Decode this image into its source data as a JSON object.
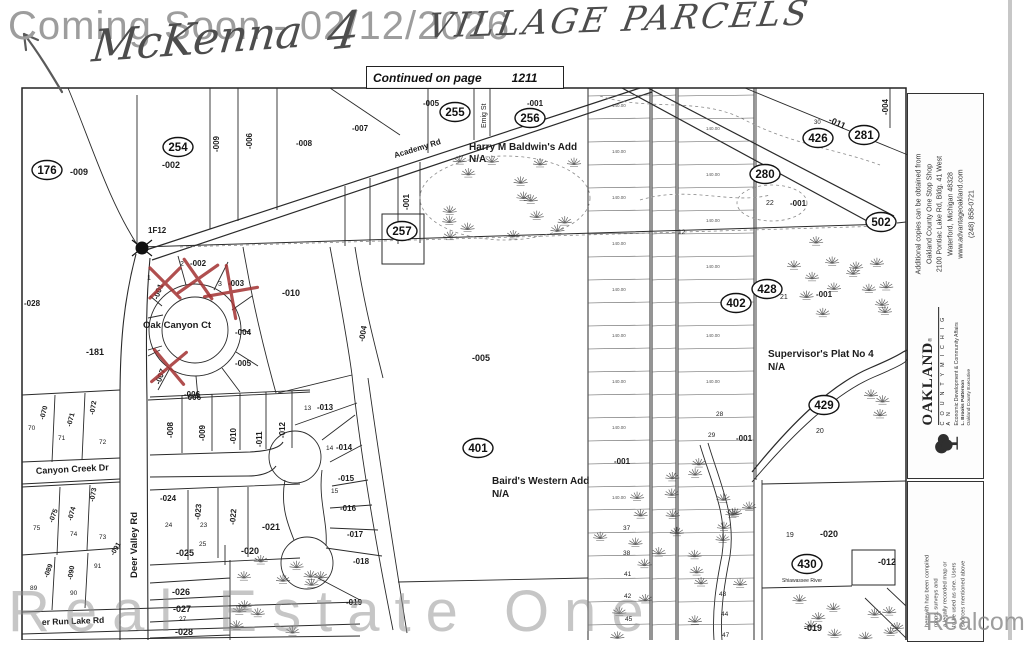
{
  "header": {
    "coming_soon": "Coming Soon - 02/12/2026",
    "handwritten_name": "McKenna",
    "handwritten_number": "4",
    "handwritten_rest": "VILLAGE PARCELS",
    "continued_label": "Continued on page",
    "continued_page": "1211"
  },
  "watermarks": {
    "bottom_left": "Real Estate One",
    "bottom_right": "Realcomp"
  },
  "sidebar": {
    "info_lines": [
      "Additional copies can be obtained from",
      "Oakland County One Stop Shop",
      "2100 Pontiac Lake Rd, Bldg. 41 West",
      "Waterford, Michigan 48328",
      "www.advantageoakland.com",
      "(248) 858-0721"
    ],
    "logo": {
      "name": "OAKLAND",
      "reg": "®",
      "subtitle": "C O U N T Y   M I C H I G A N",
      "dept": "Economic Development & Community Affairs",
      "exec_name": "L. Brooks Patterson",
      "exec_title": "Oakland County Executive"
    },
    "disclaimer_lines": [
      "herewith has been compiled",
      "maps, surveys and",
      "a legally recorded map or",
      "to be used as one.  Users",
      "sources mentioned above"
    ]
  },
  "map": {
    "parcel_circles": [
      {
        "id": "176",
        "x": 47,
        "y": 170
      },
      {
        "id": "254",
        "x": 178,
        "y": 147
      },
      {
        "id": "255",
        "x": 455,
        "y": 112
      },
      {
        "id": "256",
        "x": 530,
        "y": 118
      },
      {
        "id": "257",
        "x": 402,
        "y": 231
      },
      {
        "id": "280",
        "x": 765,
        "y": 174
      },
      {
        "id": "281",
        "x": 864,
        "y": 135
      },
      {
        "id": "426",
        "x": 818,
        "y": 138
      },
      {
        "id": "402",
        "x": 736,
        "y": 303
      },
      {
        "id": "428",
        "x": 767,
        "y": 289
      },
      {
        "id": "429",
        "x": 824,
        "y": 405
      },
      {
        "id": "430",
        "x": 807,
        "y": 564
      },
      {
        "id": "401",
        "x": 478,
        "y": 448
      },
      {
        "id": "502",
        "x": 881,
        "y": 222
      }
    ],
    "labels": [
      {
        "t": "-009",
        "x": 70,
        "y": 175
      },
      {
        "t": "-002",
        "x": 162,
        "y": 168
      },
      {
        "t": "-009",
        "x": 219,
        "y": 152,
        "r": -90,
        "s": 8
      },
      {
        "t": "-006",
        "x": 252,
        "y": 149,
        "r": -90,
        "s": 8
      },
      {
        "t": "-008",
        "x": 296,
        "y": 146,
        "s": 8
      },
      {
        "t": "-007",
        "x": 352,
        "y": 131,
        "s": 8
      },
      {
        "t": "-005",
        "x": 423,
        "y": 106,
        "s": 8
      },
      {
        "t": "Emig St",
        "x": 486,
        "y": 128,
        "r": -90,
        "s": 7,
        "w": 400
      },
      {
        "t": "-001",
        "x": 527,
        "y": 106,
        "s": 8
      },
      {
        "t": "Academy Rd",
        "x": 395,
        "y": 158,
        "r": -17,
        "s": 8
      },
      {
        "t": "Harry M Baldwin's Add",
        "x": 469,
        "y": 150,
        "s": 10
      },
      {
        "t": "N/A",
        "x": 469,
        "y": 162,
        "s": 10
      },
      {
        "t": "30",
        "x": 814,
        "y": 124,
        "s": 6,
        "w": 400
      },
      {
        "t": "-011",
        "x": 828,
        "y": 122,
        "r": 24,
        "s": 9
      },
      {
        "t": "-004",
        "x": 888,
        "y": 115,
        "r": -90,
        "s": 8
      },
      {
        "t": "22",
        "x": 766,
        "y": 205,
        "s": 7,
        "w": 400
      },
      {
        "t": "-001",
        "x": 790,
        "y": 206,
        "s": 8
      },
      {
        "t": "-001",
        "x": 409,
        "y": 210,
        "r": -90,
        "s": 8
      },
      {
        "t": "1F12",
        "x": 148,
        "y": 233,
        "s": 8
      },
      {
        "t": "1",
        "x": 147,
        "y": 280,
        "s": 7,
        "w": 400
      },
      {
        "t": "-001",
        "x": 158,
        "y": 300,
        "r": -70,
        "s": 8
      },
      {
        "t": "2",
        "x": 180,
        "y": 266,
        "s": 7,
        "w": 400
      },
      {
        "t": "-002",
        "x": 190,
        "y": 266,
        "s": 8
      },
      {
        "t": "3",
        "x": 218,
        "y": 286,
        "s": 7,
        "w": 400
      },
      {
        "t": "-003",
        "x": 228,
        "y": 286,
        "s": 8
      },
      {
        "t": "-004",
        "x": 235,
        "y": 335,
        "s": 8
      },
      {
        "t": "-005",
        "x": 235,
        "y": 366,
        "s": 8
      },
      {
        "t": "-006",
        "x": 185,
        "y": 400,
        "s": 8
      },
      {
        "t": "-007",
        "x": 160,
        "y": 385,
        "r": -70,
        "s": 8
      },
      {
        "t": "-010",
        "x": 282,
        "y": 296,
        "s": 9
      },
      {
        "t": "Oak Canyon Ct",
        "x": 143,
        "y": 328,
        "s": 9.5
      },
      {
        "t": "-181",
        "x": 86,
        "y": 355,
        "s": 9
      },
      {
        "t": "-028",
        "x": 24,
        "y": 306,
        "s": 8
      },
      {
        "t": "-004",
        "x": 364,
        "y": 342,
        "r": -80,
        "s": 8
      },
      {
        "t": "-005",
        "x": 472,
        "y": 361,
        "s": 9
      },
      {
        "t": "Baird's Western Add",
        "x": 492,
        "y": 484,
        "s": 10
      },
      {
        "t": "N/A",
        "x": 492,
        "y": 497,
        "s": 10
      },
      {
        "t": "Supervisor's Plat No 4",
        "x": 768,
        "y": 357,
        "s": 10
      },
      {
        "t": "N/A",
        "x": 768,
        "y": 370,
        "s": 10
      },
      {
        "t": "21",
        "x": 780,
        "y": 299,
        "s": 7,
        "w": 400
      },
      {
        "t": "-001",
        "x": 816,
        "y": 297,
        "s": 8
      },
      {
        "t": "20",
        "x": 816,
        "y": 433,
        "s": 7,
        "w": 400
      },
      {
        "t": "28",
        "x": 716,
        "y": 416,
        "s": 6.5,
        "w": 400
      },
      {
        "t": "29",
        "x": 708,
        "y": 437,
        "s": 6.5,
        "w": 400
      },
      {
        "t": "-001",
        "x": 736,
        "y": 441,
        "s": 8
      },
      {
        "t": "12",
        "x": 678,
        "y": 234,
        "s": 6.5,
        "w": 400
      },
      {
        "t": "-001",
        "x": 614,
        "y": 464,
        "s": 8
      },
      {
        "t": "37",
        "x": 623,
        "y": 530,
        "s": 6.5,
        "w": 400
      },
      {
        "t": "38",
        "x": 623,
        "y": 555,
        "s": 6.5,
        "w": 400
      },
      {
        "t": "41",
        "x": 624,
        "y": 576,
        "s": 6.5,
        "w": 400
      },
      {
        "t": "42",
        "x": 624,
        "y": 598,
        "s": 6.5,
        "w": 400
      },
      {
        "t": "45",
        "x": 625,
        "y": 621,
        "s": 6.5,
        "w": 400
      },
      {
        "t": "43",
        "x": 719,
        "y": 596,
        "s": 6.5,
        "w": 400
      },
      {
        "t": "44",
        "x": 721,
        "y": 616,
        "s": 6.5,
        "w": 400
      },
      {
        "t": "47",
        "x": 722,
        "y": 637,
        "s": 6.5,
        "w": 400
      },
      {
        "t": "19",
        "x": 786,
        "y": 537,
        "s": 7,
        "w": 400
      },
      {
        "t": "-020",
        "x": 820,
        "y": 537,
        "s": 9
      },
      {
        "t": "-012",
        "x": 878,
        "y": 565,
        "s": 9
      },
      {
        "t": "-019",
        "x": 804,
        "y": 631,
        "s": 9
      },
      {
        "t": "Shiawassee River",
        "x": 782,
        "y": 582,
        "s": 5,
        "w": 400
      },
      {
        "t": "-070",
        "x": 44,
        "y": 420,
        "r": -75,
        "s": 7
      },
      {
        "t": "70",
        "x": 28,
        "y": 430,
        "s": 6.5,
        "w": 400
      },
      {
        "t": "-071",
        "x": 71,
        "y": 427,
        "r": -75,
        "s": 7
      },
      {
        "t": "71",
        "x": 58,
        "y": 440,
        "s": 6.5,
        "w": 400
      },
      {
        "t": "-072",
        "x": 94,
        "y": 415,
        "r": -80,
        "s": 7
      },
      {
        "t": "72",
        "x": 99,
        "y": 444,
        "s": 6.5,
        "w": 400
      },
      {
        "t": "Canyon Creek Dr",
        "x": 36,
        "y": 474,
        "r": -3,
        "s": 9
      },
      {
        "t": "-073",
        "x": 94,
        "y": 502,
        "r": -80,
        "s": 7
      },
      {
        "t": "73",
        "x": 99,
        "y": 539,
        "s": 6.5,
        "w": 400
      },
      {
        "t": "-074",
        "x": 72,
        "y": 521,
        "r": -75,
        "s": 7
      },
      {
        "t": "74",
        "x": 70,
        "y": 536,
        "s": 6.5,
        "w": 400
      },
      {
        "t": "-075",
        "x": 53,
        "y": 523,
        "r": -70,
        "s": 7
      },
      {
        "t": "75",
        "x": 33,
        "y": 530,
        "s": 6.5,
        "w": 400
      },
      {
        "t": "-089",
        "x": 48,
        "y": 578,
        "r": -70,
        "s": 7
      },
      {
        "t": "89",
        "x": 30,
        "y": 590,
        "s": 6.5,
        "w": 400
      },
      {
        "t": "-090",
        "x": 72,
        "y": 580,
        "r": -80,
        "s": 7
      },
      {
        "t": "90",
        "x": 70,
        "y": 595,
        "s": 6.5,
        "w": 400
      },
      {
        "t": "-091",
        "x": 114,
        "y": 556,
        "r": -60,
        "s": 7
      },
      {
        "t": "91",
        "x": 94,
        "y": 568,
        "s": 6.5,
        "w": 400
      },
      {
        "t": "Deer Valley Rd",
        "x": 137,
        "y": 578,
        "r": -90,
        "s": 9.5
      },
      {
        "t": "er Run Lake Rd",
        "x": 42,
        "y": 625,
        "r": -2,
        "s": 8.5
      },
      {
        "t": "-006",
        "x": 184,
        "y": 397,
        "s": 8
      },
      {
        "t": "-008",
        "x": 173,
        "y": 438,
        "r": -90,
        "s": 8
      },
      {
        "t": "-009",
        "x": 205,
        "y": 441,
        "r": -90,
        "s": 8
      },
      {
        "t": "-010",
        "x": 236,
        "y": 444,
        "r": -90,
        "s": 8
      },
      {
        "t": "-011",
        "x": 262,
        "y": 447,
        "r": -90,
        "s": 8
      },
      {
        "t": "-012",
        "x": 285,
        "y": 438,
        "r": -90,
        "s": 8
      },
      {
        "t": "-024",
        "x": 160,
        "y": 501,
        "s": 8
      },
      {
        "t": "24",
        "x": 165,
        "y": 527,
        "s": 6.5,
        "w": 400
      },
      {
        "t": "-023",
        "x": 200,
        "y": 520,
        "r": -85,
        "s": 8
      },
      {
        "t": "23",
        "x": 200,
        "y": 527,
        "s": 6.5,
        "w": 400
      },
      {
        "t": "25",
        "x": 199,
        "y": 546,
        "s": 6.5,
        "w": 400
      },
      {
        "t": "-022",
        "x": 235,
        "y": 525,
        "r": -85,
        "s": 8
      },
      {
        "t": "-021",
        "x": 262,
        "y": 530,
        "s": 9
      },
      {
        "t": "-025",
        "x": 176,
        "y": 556,
        "s": 9
      },
      {
        "t": "-020",
        "x": 241,
        "y": 554,
        "s": 9
      },
      {
        "t": "-026",
        "x": 172,
        "y": 595,
        "s": 9
      },
      {
        "t": "-027",
        "x": 173,
        "y": 612,
        "s": 9
      },
      {
        "t": "27",
        "x": 179,
        "y": 621,
        "s": 6.5,
        "w": 400
      },
      {
        "t": "-028",
        "x": 175,
        "y": 635,
        "s": 9
      },
      {
        "t": "13",
        "x": 304,
        "y": 410,
        "s": 6.5,
        "w": 400
      },
      {
        "t": "-013",
        "x": 317,
        "y": 410,
        "s": 8
      },
      {
        "t": "14",
        "x": 326,
        "y": 450,
        "s": 6.5,
        "w": 400
      },
      {
        "t": "-014",
        "x": 336,
        "y": 450,
        "s": 8
      },
      {
        "t": "-015",
        "x": 338,
        "y": 481,
        "s": 8
      },
      {
        "t": "15",
        "x": 331,
        "y": 493,
        "s": 6.5,
        "w": 400
      },
      {
        "t": "-016",
        "x": 340,
        "y": 511,
        "s": 8
      },
      {
        "t": "-017",
        "x": 347,
        "y": 537,
        "s": 8
      },
      {
        "t": "-018",
        "x": 353,
        "y": 564,
        "s": 8
      },
      {
        "t": "-019",
        "x": 346,
        "y": 605,
        "s": 8
      },
      {
        "t": "140.00",
        "x": 612,
        "y": 107,
        "s": 4.5,
        "w": 400,
        "c": "#555"
      },
      {
        "t": "140.00",
        "x": 612,
        "y": 153,
        "s": 4.5,
        "w": 400,
        "c": "#555"
      },
      {
        "t": "140.00",
        "x": 612,
        "y": 199,
        "s": 4.5,
        "w": 400,
        "c": "#555"
      },
      {
        "t": "140.00",
        "x": 612,
        "y": 245,
        "s": 4.5,
        "w": 400,
        "c": "#555"
      },
      {
        "t": "140.00",
        "x": 612,
        "y": 291,
        "s": 4.5,
        "w": 400,
        "c": "#555"
      },
      {
        "t": "140.00",
        "x": 612,
        "y": 337,
        "s": 4.5,
        "w": 400,
        "c": "#555"
      },
      {
        "t": "140.00",
        "x": 612,
        "y": 383,
        "s": 4.5,
        "w": 400,
        "c": "#555"
      },
      {
        "t": "140.00",
        "x": 612,
        "y": 429,
        "s": 4.5,
        "w": 400,
        "c": "#555"
      },
      {
        "t": "140.00",
        "x": 612,
        "y": 499,
        "s": 4.5,
        "w": 400,
        "c": "#555"
      },
      {
        "t": "140.00",
        "x": 706,
        "y": 130,
        "s": 4.5,
        "w": 400,
        "c": "#555"
      },
      {
        "t": "140.00",
        "x": 706,
        "y": 176,
        "s": 4.5,
        "w": 400,
        "c": "#555"
      },
      {
        "t": "140.00",
        "x": 706,
        "y": 222,
        "s": 4.5,
        "w": 400,
        "c": "#555"
      },
      {
        "t": "140.00",
        "x": 706,
        "y": 268,
        "s": 4.5,
        "w": 400,
        "c": "#555"
      },
      {
        "t": "140.00",
        "x": 706,
        "y": 337,
        "s": 4.5,
        "w": 400,
        "c": "#555"
      },
      {
        "t": "140.00",
        "x": 706,
        "y": 383,
        "s": 4.5,
        "w": 400,
        "c": "#555"
      }
    ],
    "x_marks": [
      {
        "x": 165,
        "y": 283,
        "s": 15,
        "r": 0
      },
      {
        "x": 198,
        "y": 279,
        "s": 17,
        "r": 10
      },
      {
        "x": 231,
        "y": 292,
        "s": 19,
        "r": 35
      },
      {
        "x": 169,
        "y": 367,
        "s": 16,
        "r": 5
      }
    ]
  }
}
